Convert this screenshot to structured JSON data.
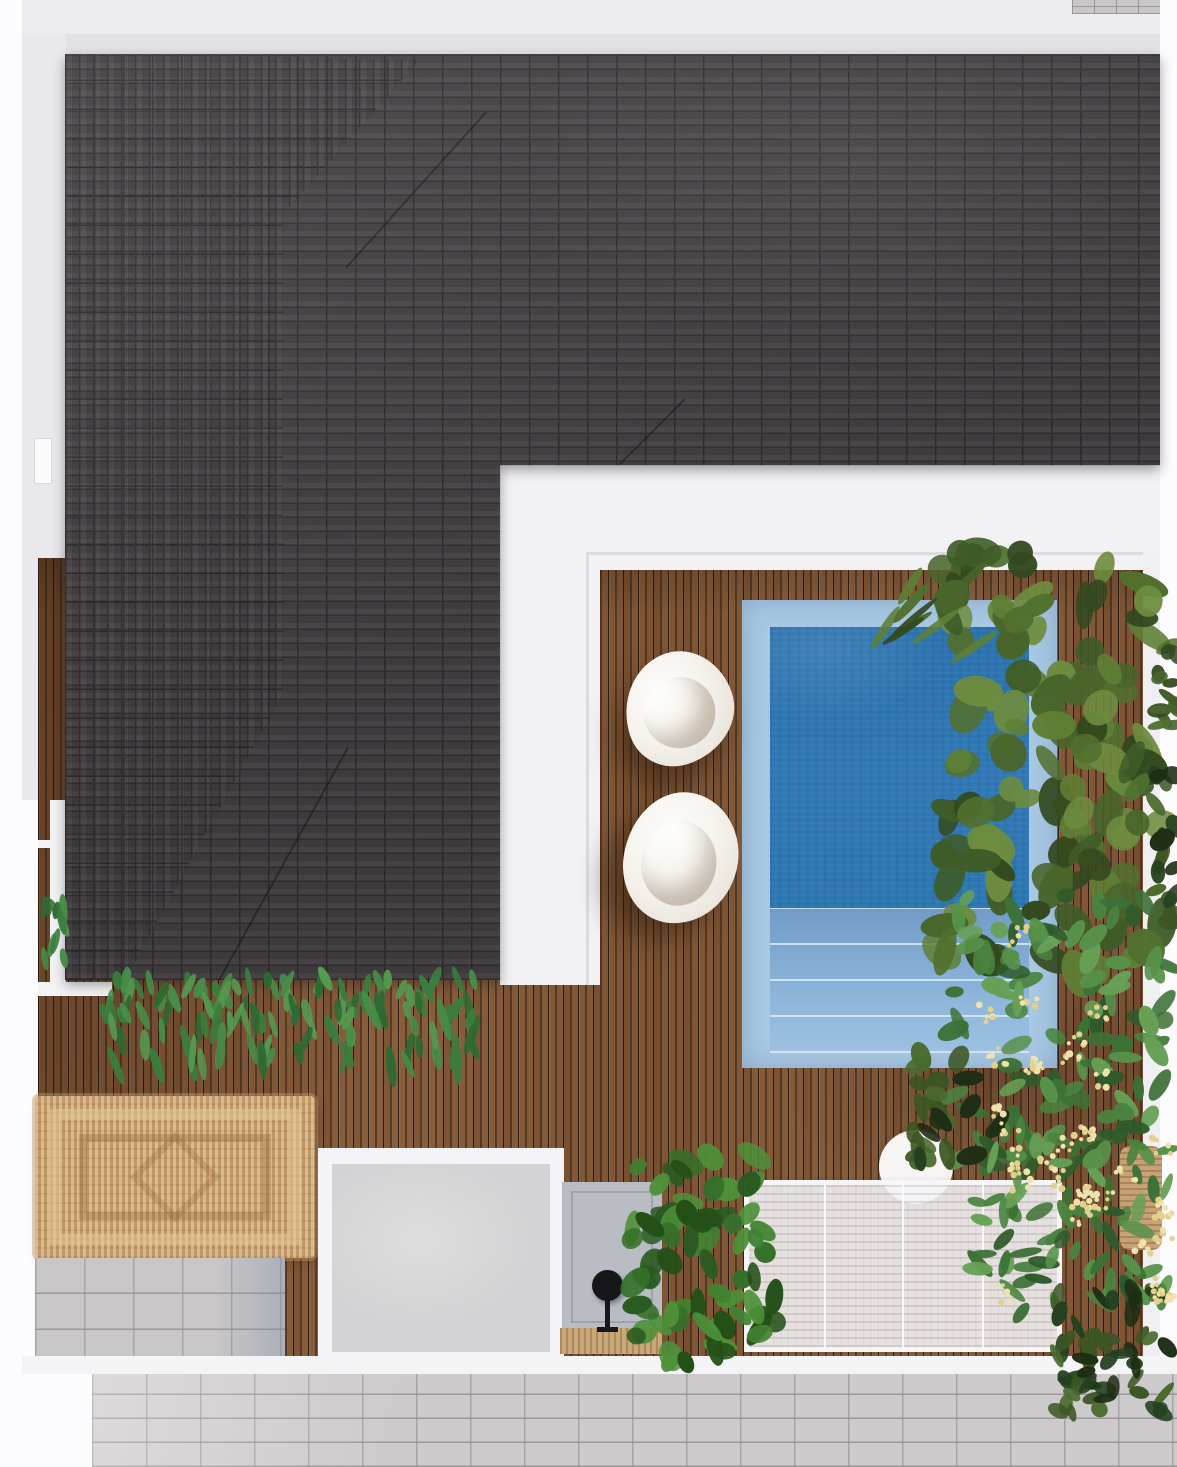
{
  "meta": {
    "description": "Top-down 3D architectural render of a villa with dark shingle hip roof, timber pool deck, plunge pool, pergola and tropical landscaping",
    "view": "aerial top-down",
    "visible_text": "none"
  },
  "colors": {
    "page_bg": "#fcfbfd",
    "top_strip": "#ecebee",
    "eave_band": "#e2e1e5",
    "wall_gray": "#e9e8ec",
    "terrace_white": "#f2f1f4",
    "step_line": "#dcdbde",
    "roof_base": "#4a4548",
    "roof_joint": "#353237",
    "deck_base": "#82593a",
    "pool_coping": "#a7c7e3",
    "pool_water": "#2f79b5",
    "pool_steps": "#84add4",
    "bean_bag": "#f6f3ee",
    "rug_base": "#cfa877",
    "paver_gray": "#c9c6c8",
    "walkway_gray": "#cdcacc",
    "concrete_pad": "#d3d2d4",
    "pad_white": "#f4f3f5",
    "small_pad": "#b9bdc3",
    "mat_tan": "#c9a87a",
    "lamp_black": "#17171a",
    "pergola_white": "#f3f2f5",
    "table_white": "#f2f0ef",
    "wicker_tan": "#c7a276",
    "flower_cream": "#eee0a8"
  },
  "plants": {
    "palettes": {
      "banana": [
        "#3f5c28",
        "#51702e",
        "#5f7f35",
        "#6d8c3f",
        "#49652b",
        "#33491f"
      ],
      "shrub": [
        "#2f5b2b",
        "#3c7136",
        "#4a8340",
        "#58924a",
        "#66a055"
      ],
      "monstera": [
        "#2a5a22",
        "#35702a",
        "#418231",
        "#4d9038",
        "#245018"
      ],
      "fern": [
        "#2e6a33",
        "#3a7d3e",
        "#478c48",
        "#55984f"
      ],
      "dark": [
        "#24401f",
        "#1f2e14",
        "#3c5524",
        "#4a6a2c"
      ],
      "flower": [
        "#f0e2ac",
        "#e3cf8e"
      ]
    }
  },
  "scene": {
    "objects": [
      {
        "name": "roof",
        "label": "Dark shingle hip roof (L-shaped)"
      },
      {
        "name": "timber-deck",
        "label": "Vertical-plank timber deck"
      },
      {
        "name": "plunge-pool",
        "label": "Plunge pool with light coping and three steps"
      },
      {
        "name": "bean-bag-lounger",
        "label": "White bean bag loungers",
        "count": 2
      },
      {
        "name": "jute-rug",
        "label": "Woven jute rug with border pattern"
      },
      {
        "name": "concrete-pad",
        "label": "Concrete patio pad with white surround"
      },
      {
        "name": "utility-pad",
        "label": "Small blue-gray utility pad"
      },
      {
        "name": "outdoor-lamp",
        "label": "Black outdoor lamp on stand"
      },
      {
        "name": "pergola",
        "label": "Translucent slatted pergola canopy"
      },
      {
        "name": "round-table",
        "label": "Round white outdoor table"
      },
      {
        "name": "wicker-chair",
        "label": "Rattan hanging chair (partially hidden)"
      },
      {
        "name": "tropical-planting",
        "label": "Tropical planting beds along right boundary"
      },
      {
        "name": "flowering-shrub",
        "label": "Shrubs with cream blossom clusters"
      },
      {
        "name": "fern-row",
        "label": "Fern row along roof eave"
      },
      {
        "name": "paver-walkway",
        "label": "Concrete paver walkway along bottom"
      }
    ]
  }
}
